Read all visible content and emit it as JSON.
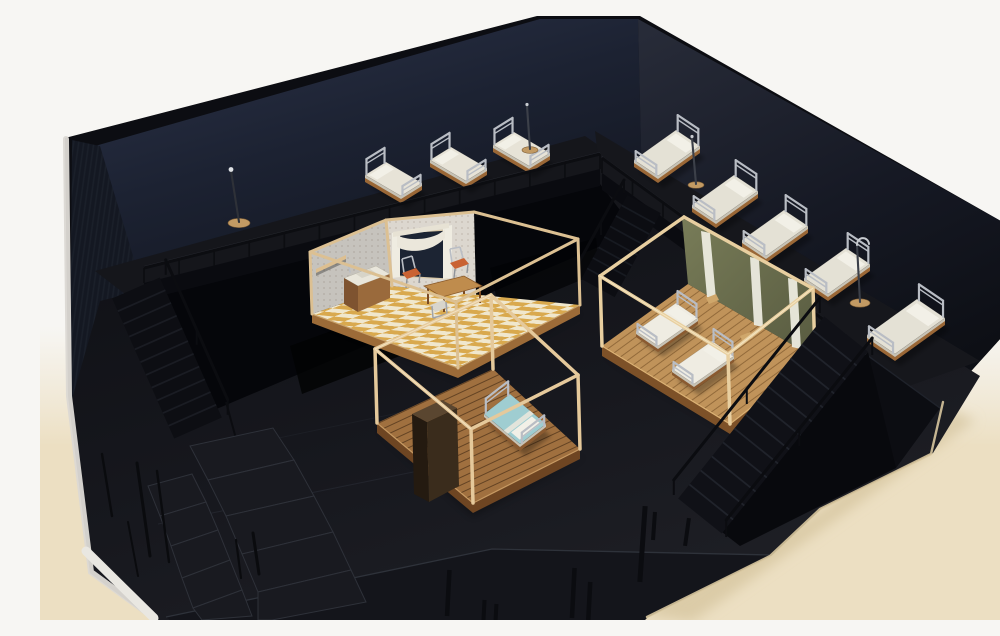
{
  "meta": {
    "description": "Photograph of an architectural scale model of a black-box theatre stage set on a cream table: dark navy walls, a raised perimeter platform with miniature hospital beds behind a black railing, three open wooden-frame room vignettes (a wallpapered kitchen with checkered floor, an empty bedroom frame with a teal-covered bed and wardrobe, an olive-green ward with two white beds), three black staircases and stacked black riser blocks.",
    "width": 1000,
    "height": 604
  },
  "palette": {
    "background_wall": "#f7f6f3",
    "table_cream": "#ecdfc2",
    "model_black": "#0c0d12",
    "wall_navy": "#1c2232",
    "floor_charcoal": "#17181e",
    "wood_light": "#e2c596",
    "wood_mid": "#b07c44",
    "wood_dark": "#6e4522",
    "mattress": "#e6e2d6",
    "metal": "#b9bdc4",
    "teal_blanket": "#9fcdd1",
    "olive_wall": "#6e7150",
    "checker_gold": "#d9a94e",
    "wallpaper": "#e9e4da"
  },
  "counts": {
    "beds_total": 11,
    "beds_back_platform": 3,
    "beds_right_platform": 5,
    "beds_ward_room": 2,
    "beds_teal": 1,
    "staircases": 3,
    "room_vignettes": 3,
    "floor_lamps": 1,
    "iv_stands": 3,
    "riser_blocks": 10
  },
  "scene": {
    "beds": {
      "groups": {
        "back": {
          "u": [
            36,
            21
          ],
          "v": [
            -21,
            13
          ],
          "head": 15,
          "foot": 9,
          "base": 7,
          "top": "#e7e3d7",
          "wood": "#9a6736"
        },
        "right": {
          "u": [
            -42,
            30
          ],
          "v": [
            -24,
            -16
          ],
          "head": 16,
          "foot": 10,
          "base": 7,
          "top": "#e4e1d5",
          "wood": "#9a6736"
        },
        "ward": {
          "u": [
            -40,
            28
          ],
          "v": [
            -22,
            -15
          ],
          "head": 13,
          "foot": 8,
          "base": 6,
          "top": "#efece2",
          "wood": "#8a5a30"
        },
        "teal": {
          "u": [
            36,
            30
          ],
          "v": [
            -26,
            20
          ],
          "head": 14,
          "foot": 10,
          "base": 7,
          "top": "#9fcdd1",
          "wood": "#8a5a30",
          "pillowAtFoot": true
        }
      },
      "items": [
        {
          "g": "back",
          "p": [
            346,
            146
          ]
        },
        {
          "g": "back",
          "p": [
            411,
            131
          ]
        },
        {
          "g": "back",
          "p": [
            474,
            116
          ]
        },
        {
          "g": "right",
          "p": [
            660,
            130
          ]
        },
        {
          "g": "right",
          "p": [
            718,
            175
          ]
        },
        {
          "g": "right",
          "p": [
            768,
            210
          ]
        },
        {
          "g": "right",
          "p": [
            830,
            248
          ]
        },
        {
          "g": "right",
          "p": [
            905,
            302
          ],
          "u": [
            -50,
            36
          ],
          "v": [
            -28,
            -19
          ]
        },
        {
          "g": "ward",
          "p": [
            658,
            302
          ],
          "layer": "ward-beds"
        },
        {
          "g": "ward",
          "p": [
            694,
            340
          ],
          "layer": "ward-beds"
        },
        {
          "g": "teal",
          "p": [
            470,
            378
          ],
          "layer": "teal-bed"
        }
      ]
    },
    "railings": [
      {
        "a": [
          104,
          252
        ],
        "b": [
          560,
          138
        ],
        "n": 13,
        "drop": 15
      },
      {
        "a": [
          562,
          142
        ],
        "b": [
          806,
          320
        ],
        "n": 8,
        "drop": 15
      }
    ],
    "stairs_back": [
      {
        "name": "left-staircase",
        "a": [
          96,
          272
        ],
        "b": [
          158,
          412
        ],
        "w": 52,
        "n": 11,
        "fill": "#0d0e13",
        "tread": "#1a1c23",
        "rails": [
          [
            -1.25,
            15
          ]
        ]
      },
      {
        "name": "back-right-staircase",
        "a": [
          604,
          188
        ],
        "b": [
          558,
          272
        ],
        "w": 38,
        "n": 8,
        "fill": "#0c0d12",
        "tread": "#171a21",
        "rails": [
          [
            1.2,
            13
          ]
        ]
      }
    ],
    "stairs_front": [
      {
        "name": "foreground-staircase",
        "a": [
          806,
          318
        ],
        "b": [
          660,
          500
        ],
        "w": 56,
        "n": 13,
        "fill": "#101117",
        "tread": "#20232b",
        "rails": [
          [
            1.2,
            15
          ],
          [
            -1.2,
            17
          ]
        ]
      }
    ],
    "stands": [
      {
        "t": "lamp",
        "base": [
          199,
          207
        ],
        "top": [
          191,
          155
        ]
      },
      {
        "t": "pole",
        "base": [
          490,
          134
        ],
        "top": [
          487,
          90
        ]
      },
      {
        "t": "pole",
        "base": [
          656,
          169
        ],
        "top": [
          652,
          122
        ]
      },
      {
        "t": "hook",
        "base": [
          820,
          287
        ],
        "top": [
          817,
          229
        ]
      }
    ]
  }
}
